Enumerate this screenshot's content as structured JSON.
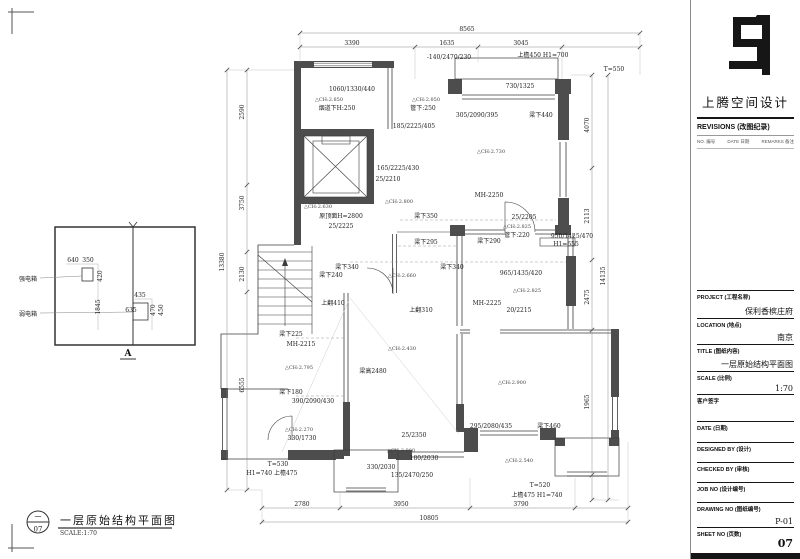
{
  "sidebar": {
    "logo_name": "上腾空间设计",
    "revisions": {
      "title": "REVISIONS (改图纪录)",
      "cols": [
        "NO. 编号",
        "DATE 日期",
        "REMARKS 备注"
      ]
    },
    "fields": [
      {
        "label": "PROJECT (工程名称)",
        "value": "保利香槟庄府"
      },
      {
        "label": "LOCATION (地点)",
        "value": "南京"
      },
      {
        "label": "TITLE (图纸内容)",
        "value": "一层原始结构平面图"
      },
      {
        "label": "SCALE (比例)",
        "value": "1:70"
      },
      {
        "label": "客户签字",
        "value": ""
      },
      {
        "label": "DATE (日期)",
        "value": ""
      },
      {
        "label": "DESIGNED BY (设计)",
        "value": ""
      },
      {
        "label": "CHECKED BY (审核)",
        "value": ""
      },
      {
        "label": "JOB NO (设计编号)",
        "value": ""
      },
      {
        "label": "DRAWING NO (图纸编号)",
        "value": "P-01"
      },
      {
        "label": "SHEET NO (页数)",
        "value": "07"
      }
    ]
  },
  "legend": {
    "circle_top": "一",
    "circle_bottom": "07",
    "title": "一层原始结构平面图",
    "scale": "SCALE:1:70"
  },
  "detail_box": {
    "label_top": "强电箱",
    "label_bottom": "弱电箱",
    "mark": "A"
  },
  "colors": {
    "wall": "#4d4d4d",
    "line": "#3c3c3c",
    "dim": "#8a8a8a",
    "bar": "#161616"
  },
  "plan": {
    "annotations": [
      {
        "t": "8565",
        "x": 467,
        "y": 31,
        "c": "d"
      },
      {
        "t": "3390",
        "x": 352,
        "y": 45,
        "c": "d"
      },
      {
        "t": "1635",
        "x": 447,
        "y": 45,
        "c": "d"
      },
      {
        "t": "3045",
        "x": 521,
        "y": 45,
        "c": "d"
      },
      {
        "t": "-140/2470/230",
        "x": 449,
        "y": 59,
        "c": "d"
      },
      {
        "t": "上檐450 H1=700",
        "x": 543,
        "y": 57,
        "c": "d"
      },
      {
        "t": "T=550",
        "x": 614,
        "y": 71,
        "c": "d"
      },
      {
        "t": "1060/1330/440",
        "x": 352,
        "y": 91,
        "c": "d"
      },
      {
        "t": "△CH:2.850",
        "x": 329,
        "y": 101,
        "c": "s"
      },
      {
        "t": "烟道下H:250",
        "x": 337,
        "y": 110,
        "c": "n"
      },
      {
        "t": "△CH:2.850",
        "x": 426,
        "y": 101,
        "c": "s"
      },
      {
        "t": "管下:250",
        "x": 423,
        "y": 110,
        "c": "n"
      },
      {
        "t": "730/1325",
        "x": 520,
        "y": 88,
        "c": "d"
      },
      {
        "t": "305/2090/395",
        "x": 477,
        "y": 117,
        "c": "d"
      },
      {
        "t": "梁下440",
        "x": 541,
        "y": 117,
        "c": "n"
      },
      {
        "t": "185/2225/405",
        "x": 414,
        "y": 128,
        "c": "d"
      },
      {
        "t": "△CH:2.730",
        "x": 491,
        "y": 153,
        "c": "s"
      },
      {
        "t": "165/2225/430",
        "x": 398,
        "y": 170,
        "c": "d"
      },
      {
        "t": "25/2210",
        "x": 388,
        "y": 181,
        "c": "d"
      },
      {
        "t": "MH-2250",
        "x": 489,
        "y": 197,
        "c": "n"
      },
      {
        "t": "△CH:2.800",
        "x": 399,
        "y": 203,
        "c": "s"
      },
      {
        "t": "△CH:2.630",
        "x": 318,
        "y": 208,
        "c": "s"
      },
      {
        "t": "原顶面H=2800",
        "x": 341,
        "y": 218,
        "c": "n"
      },
      {
        "t": "梁下350",
        "x": 426,
        "y": 218,
        "c": "n"
      },
      {
        "t": "25/2225",
        "x": 341,
        "y": 228,
        "c": "d"
      },
      {
        "t": "25/2205",
        "x": 524,
        "y": 219,
        "c": "d"
      },
      {
        "t": "△CH:2.825",
        "x": 517,
        "y": 228,
        "c": "s"
      },
      {
        "t": "管下:220",
        "x": 517,
        "y": 237,
        "c": "n"
      },
      {
        "t": "梁下290",
        "x": 489,
        "y": 243,
        "c": "n"
      },
      {
        "t": "950/1425/470",
        "x": 572,
        "y": 238,
        "c": "d"
      },
      {
        "t": "H1=655",
        "x": 566,
        "y": 246,
        "c": "d"
      },
      {
        "t": "梁下295",
        "x": 426,
        "y": 244,
        "c": "n"
      },
      {
        "t": "梁下340",
        "x": 347,
        "y": 269,
        "c": "n"
      },
      {
        "t": "梁下340",
        "x": 452,
        "y": 269,
        "c": "n"
      },
      {
        "t": "梁下240",
        "x": 331,
        "y": 277,
        "c": "n"
      },
      {
        "t": "△CH:2.660",
        "x": 402,
        "y": 277,
        "c": "s"
      },
      {
        "t": "上翻410",
        "x": 333,
        "y": 305,
        "c": "n"
      },
      {
        "t": "上翻310",
        "x": 421,
        "y": 312,
        "c": "n"
      },
      {
        "t": "965/1435/420",
        "x": 521,
        "y": 275,
        "c": "d"
      },
      {
        "t": "△CH:2.825",
        "x": 527,
        "y": 292,
        "c": "s"
      },
      {
        "t": "MH-2225",
        "x": 487,
        "y": 305,
        "c": "n"
      },
      {
        "t": "20/2215",
        "x": 519,
        "y": 312,
        "c": "d"
      },
      {
        "t": "梁下225",
        "x": 291,
        "y": 336,
        "c": "n"
      },
      {
        "t": "MH-2215",
        "x": 301,
        "y": 346,
        "c": "n"
      },
      {
        "t": "△CH:2.795",
        "x": 299,
        "y": 369,
        "c": "s"
      },
      {
        "t": "△CH:2.430",
        "x": 402,
        "y": 350,
        "c": "s"
      },
      {
        "t": "梁高2480",
        "x": 373,
        "y": 373,
        "c": "n"
      },
      {
        "t": "梁下180",
        "x": 291,
        "y": 394,
        "c": "n"
      },
      {
        "t": "390/2090/430",
        "x": 313,
        "y": 403,
        "c": "d"
      },
      {
        "t": "△CH:2.270",
        "x": 299,
        "y": 431,
        "c": "s"
      },
      {
        "t": "330/1730",
        "x": 302,
        "y": 440,
        "c": "d"
      },
      {
        "t": "T=530",
        "x": 278,
        "y": 466,
        "c": "d"
      },
      {
        "t": "H1=740 上檐475",
        "x": 272,
        "y": 475,
        "c": "d"
      },
      {
        "t": "330/2030",
        "x": 381,
        "y": 469,
        "c": "d"
      },
      {
        "t": "25/2350",
        "x": 414,
        "y": 437,
        "c": "d"
      },
      {
        "t": "△CH:2.900",
        "x": 401,
        "y": 452,
        "c": "s"
      },
      {
        "t": "180/2030",
        "x": 424,
        "y": 460,
        "c": "d"
      },
      {
        "t": "135/2470/250",
        "x": 412,
        "y": 477,
        "c": "d"
      },
      {
        "t": "295/2080/435",
        "x": 491,
        "y": 428,
        "c": "d"
      },
      {
        "t": "梁下460",
        "x": 549,
        "y": 428,
        "c": "n"
      },
      {
        "t": "△CH:2.900",
        "x": 512,
        "y": 384,
        "c": "s"
      },
      {
        "t": "△CH:2.540",
        "x": 519,
        "y": 462,
        "c": "s"
      },
      {
        "t": "T=520",
        "x": 540,
        "y": 487,
        "c": "d"
      },
      {
        "t": "上檐475 H1=740",
        "x": 537,
        "y": 497,
        "c": "d"
      },
      {
        "t": "2780",
        "x": 302,
        "y": 506,
        "c": "d"
      },
      {
        "t": "3950",
        "x": 401,
        "y": 506,
        "c": "d"
      },
      {
        "t": "3790",
        "x": 521,
        "y": 506,
        "c": "d"
      },
      {
        "t": "10805",
        "x": 429,
        "y": 520,
        "c": "d"
      },
      {
        "t": "2590",
        "x": 244,
        "y": 112,
        "c": "v",
        "r": -90
      },
      {
        "t": "3750",
        "x": 244,
        "y": 203,
        "c": "v",
        "r": -90
      },
      {
        "t": "2130",
        "x": 244,
        "y": 274,
        "c": "v",
        "r": -90
      },
      {
        "t": "6555",
        "x": 244,
        "y": 385,
        "c": "v",
        "r": -90
      },
      {
        "t": "13380",
        "x": 224,
        "y": 262,
        "c": "v",
        "r": -90
      },
      {
        "t": "4070",
        "x": 589,
        "y": 125,
        "c": "v",
        "r": -90
      },
      {
        "t": "2113",
        "x": 589,
        "y": 216,
        "c": "v",
        "r": -90
      },
      {
        "t": "2475",
        "x": 589,
        "y": 297,
        "c": "v",
        "r": -90
      },
      {
        "t": "1965",
        "x": 589,
        "y": 402,
        "c": "v",
        "r": -90
      },
      {
        "t": "14135",
        "x": 605,
        "y": 276,
        "c": "v",
        "r": -90
      },
      {
        "t": "强电箱",
        "x": 28,
        "y": 281,
        "c": "n"
      },
      {
        "t": "弱电箱",
        "x": 28,
        "y": 316,
        "c": "n"
      },
      {
        "t": "640",
        "x": 73,
        "y": 262,
        "c": "d"
      },
      {
        "t": "350",
        "x": 88,
        "y": 262,
        "c": "d"
      },
      {
        "t": "420",
        "x": 102,
        "y": 276,
        "c": "v",
        "r": -90
      },
      {
        "t": "1845",
        "x": 100,
        "y": 307,
        "c": "v",
        "r": -90
      },
      {
        "t": "435",
        "x": 140,
        "y": 297,
        "c": "d"
      },
      {
        "t": "635",
        "x": 131,
        "y": 312,
        "c": "d"
      },
      {
        "t": "470",
        "x": 155,
        "y": 310,
        "c": "v",
        "r": -90
      },
      {
        "t": "450",
        "x": 163,
        "y": 310,
        "c": "v",
        "r": -90
      },
      {
        "t": "A",
        "x": 128,
        "y": 356,
        "c": "mk"
      }
    ]
  }
}
